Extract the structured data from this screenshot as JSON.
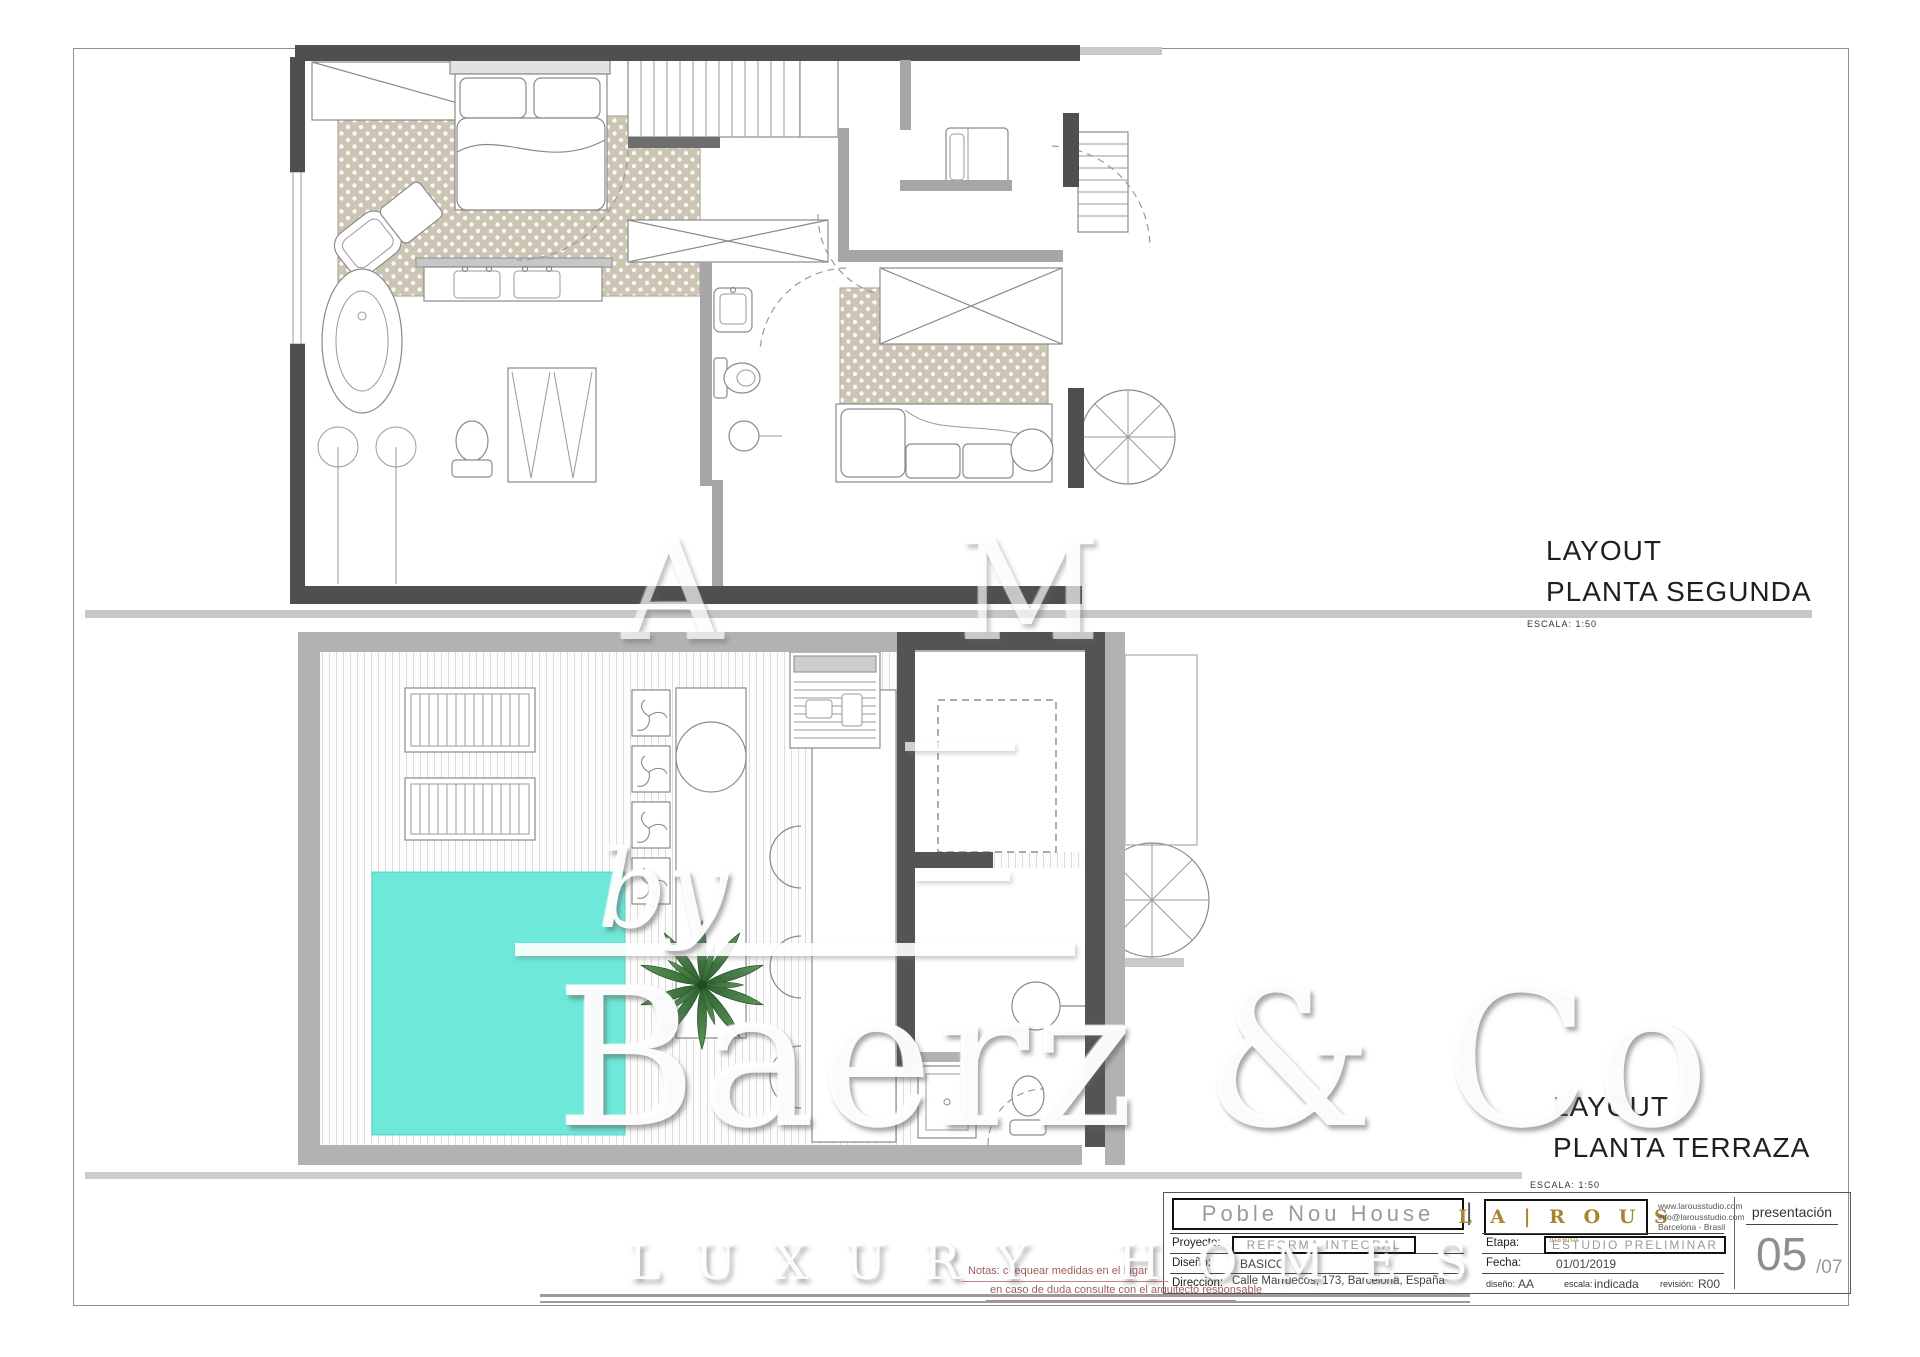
{
  "plans": [
    {
      "title": "LAYOUT",
      "subtitle": "PLANTA SEGUNDA",
      "scale": "ESCALA: 1:50"
    },
    {
      "title": "LAYOUT",
      "subtitle": "PLANTA TERRAZA",
      "scale": "ESCALA: 1:50"
    }
  ],
  "title_block": {
    "project_name": "Poble Nou House",
    "divider": "|",
    "logo": {
      "name": "L A | R O U S",
      "tagline": "diseño"
    },
    "contact": [
      "www.larousstudio.com",
      "info@larousstudio.com",
      "Barcelona - Brasil"
    ],
    "rows_left": [
      {
        "label": "Proyecto:",
        "value": "REFORMA INTEGRAL"
      },
      {
        "label": "Diseño:",
        "value": "BASICO"
      },
      {
        "label": "Dirección:",
        "value": "Calle Marruecos, 173, Barcelona, España"
      }
    ],
    "rows_mid": [
      {
        "label": "Etapa:",
        "value": "ESTUDIO PRELIMINAR"
      },
      {
        "label": "Fecha:",
        "value": "01/01/2019"
      }
    ],
    "meta": {
      "diseno_label": "diseño:",
      "diseno_value": "AA",
      "escala_label": "escala:",
      "escala_value": "indicada",
      "revision_label": "revisión:",
      "revision_value": "R00"
    },
    "sheet_type": "presentación",
    "sheet_number": "05",
    "sheet_total": "/07"
  },
  "notes": {
    "line1": "Notas: chequear medidas en el lugar",
    "line2": "en caso de duda consulte con el arquitecto responsable"
  },
  "watermark": {
    "by": "by",
    "brand": "Baerz & Co",
    "tagline": "LUXURY HOMES",
    "ghost": "A M"
  },
  "colors": {
    "pool": "#6ee8d8",
    "accent_gold": "#a8862f",
    "note_red": "#a05c5c",
    "wall_dark": "#4f4f4f",
    "wall_light": "#b2b2b2"
  }
}
